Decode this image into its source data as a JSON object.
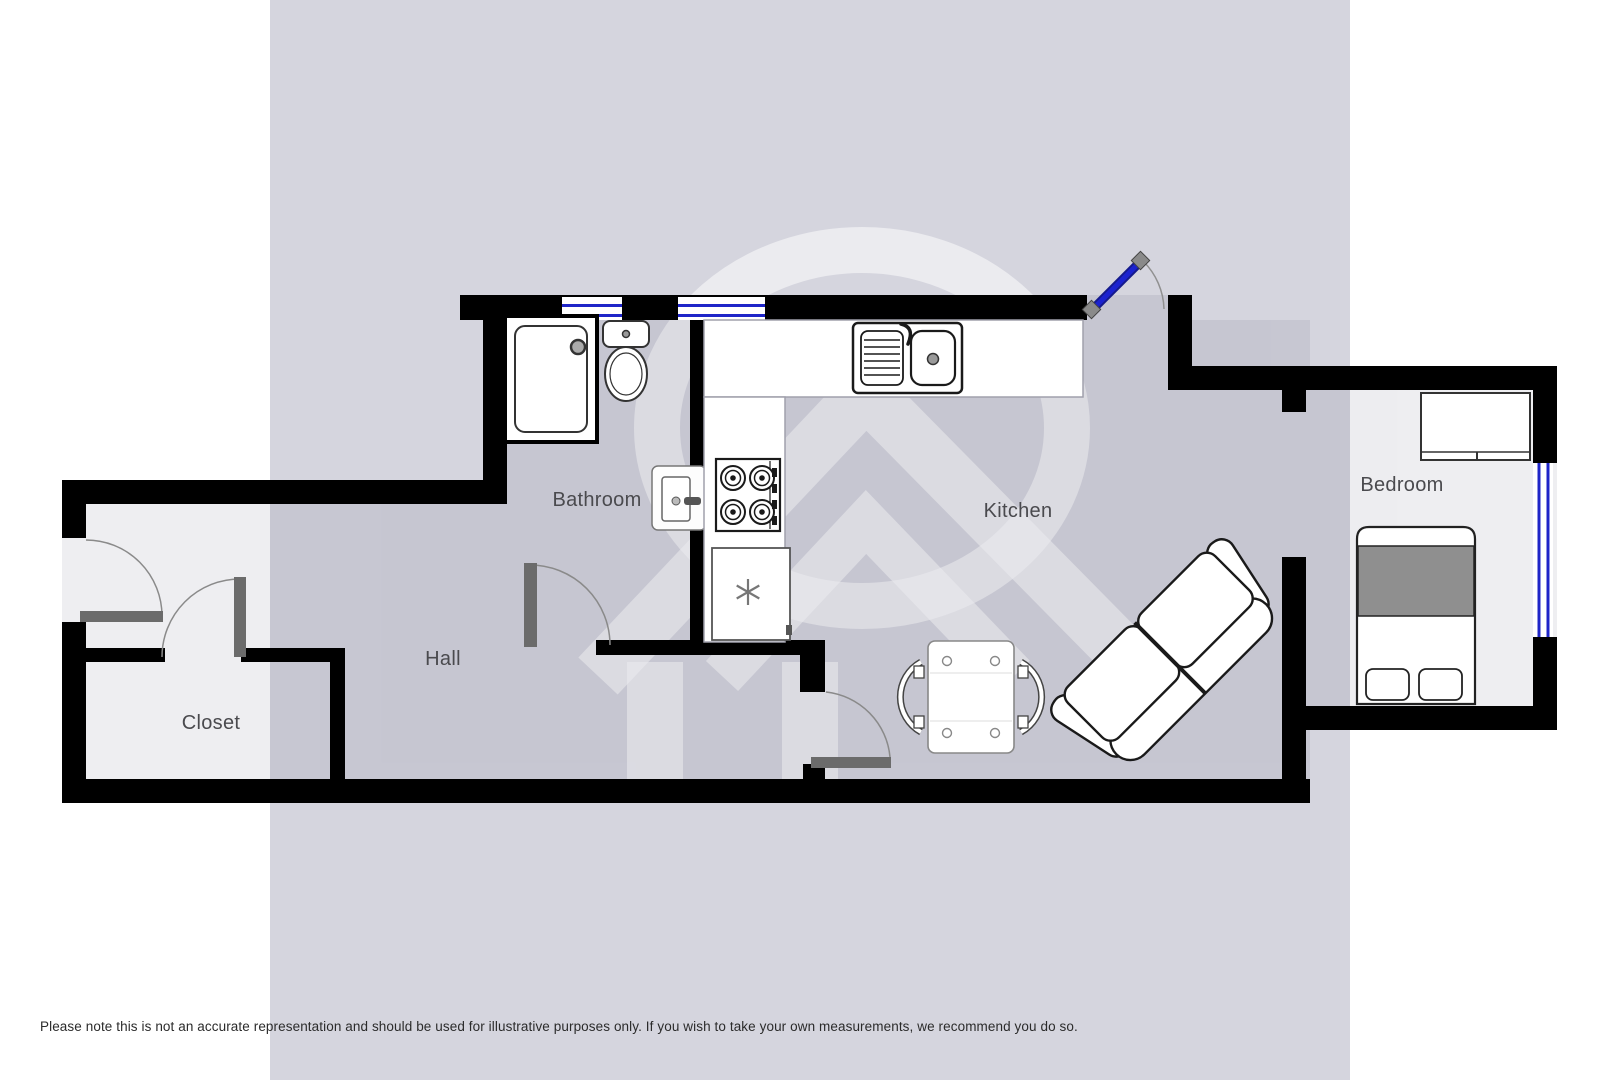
{
  "floorplan": {
    "rooms": {
      "bathroom": {
        "label": "Bathroom"
      },
      "kitchen": {
        "label": "Kitchen"
      },
      "bedroom": {
        "label": "Bedroom"
      },
      "hall": {
        "label": "Hall"
      },
      "closet": {
        "label": "Closet"
      }
    },
    "colors": {
      "wall": "#000000",
      "watermark_band": "#d5d5de",
      "window_blue": "#1f25c8",
      "entry_door_blue": "#1b22cf",
      "door_leaf_gray": "#6b6b6b",
      "duvet_gray": "#8f8f8f"
    }
  },
  "footer": {
    "disclaimer": "Please note this is not an accurate representation and should be used for illustrative purposes only. If you wish to take your own measurements, we recommend you do so."
  }
}
